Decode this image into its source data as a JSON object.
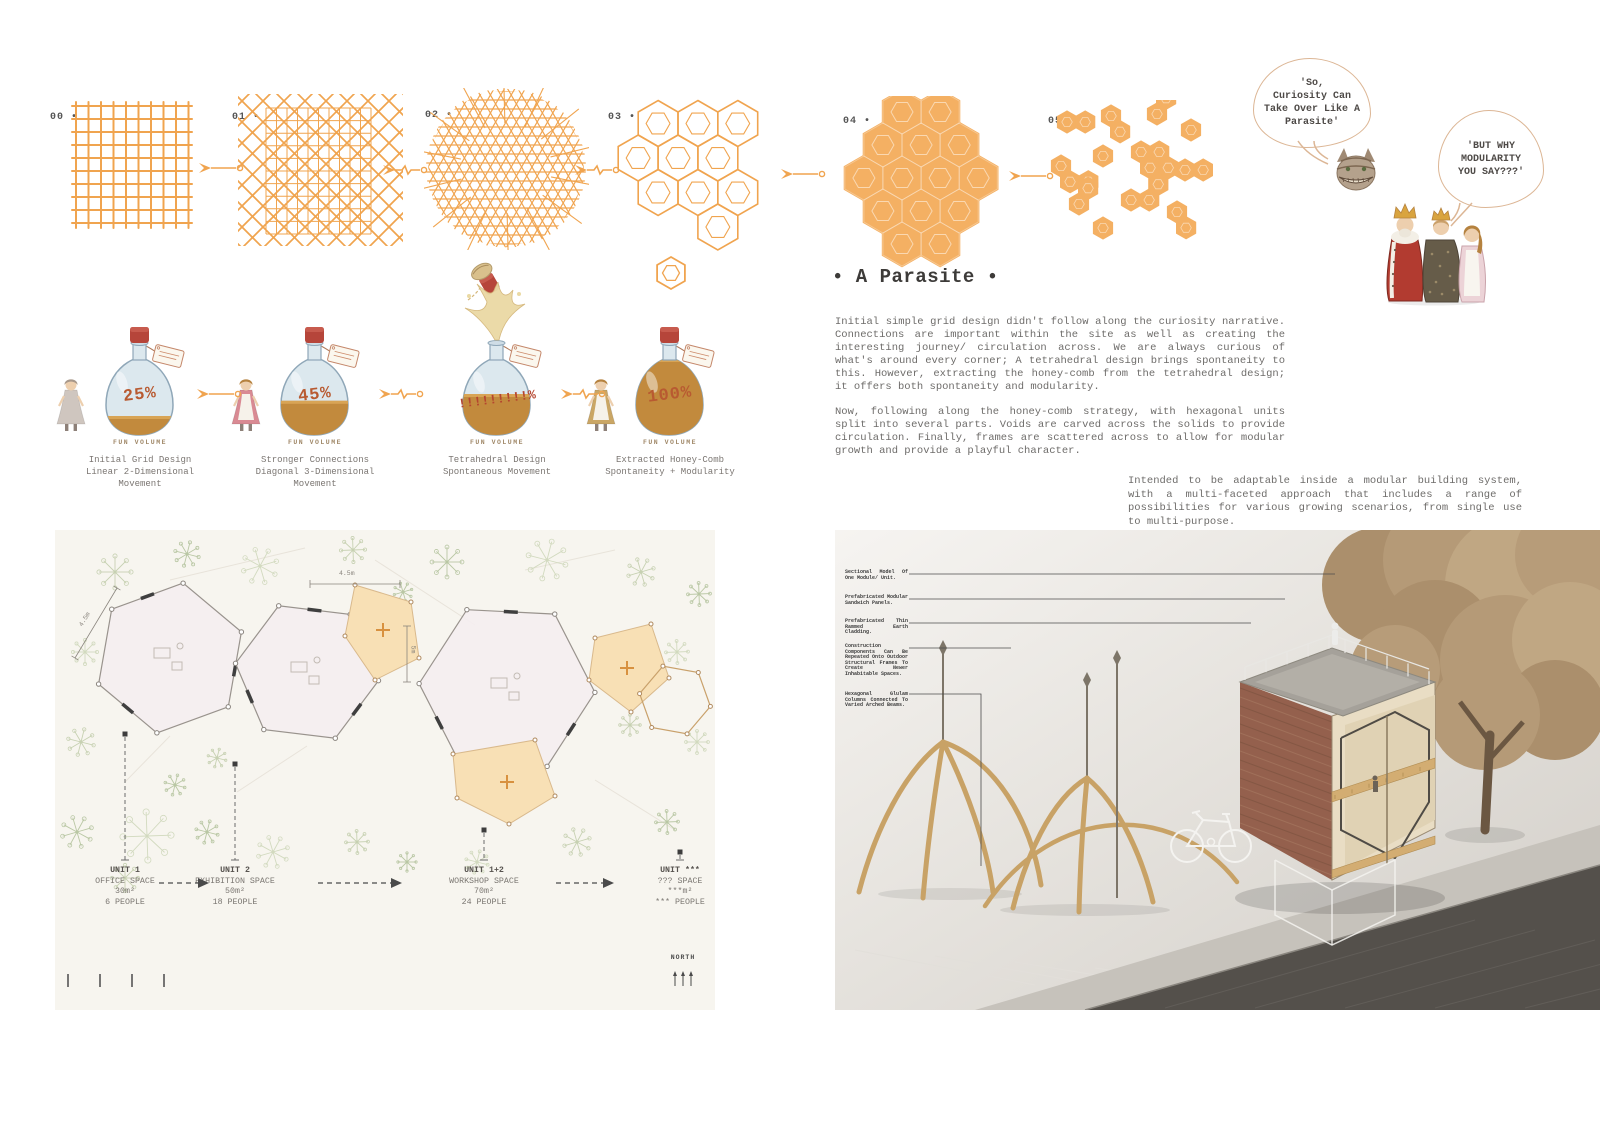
{
  "colors": {
    "accent": "#f0a44f",
    "accent_fill": "#f4b063",
    "bubble_stroke": "#dcb695",
    "ink": "#3d3b39",
    "body_text": "#6e6c6a",
    "plan_bg": "#f7f5ef",
    "annex_fill": "#f8e0b5",
    "brick": "#94604d",
    "timber": "#c8a266"
  },
  "process": {
    "steps": [
      {
        "label": "00 •",
        "type": "grid"
      },
      {
        "label": "01 •",
        "type": "diagonal-grid"
      },
      {
        "label": "02 •",
        "type": "tetrahedral-mesh"
      },
      {
        "label": "03 •",
        "type": "honeycomb-outline"
      },
      {
        "label": "04 •",
        "type": "honeycomb-solid"
      },
      {
        "label": "05 •",
        "type": "honeycomb-scattered"
      }
    ]
  },
  "bubbles": {
    "cat": "'So,\nCuriosity Can\nTake Over Like A\nParasite'",
    "royals": "'BUT WHY\nMODULARITY\nYOU SAY???'"
  },
  "potions": {
    "fun_label": "FUN VOLUME",
    "items": [
      {
        "value": "25%",
        "caption": "Initial Grid Design\nLinear 2-Dimensional\nMovement"
      },
      {
        "value": "45%",
        "caption": "Stronger Connections\nDiagonal 3-Dimensional\nMovement"
      },
      {
        "value": "!!!!!!!!!%",
        "caption": "Tetrahedral Design\nSpontaneous Movement"
      },
      {
        "value": "100%",
        "caption": "Extracted Honey-Comb\nSpontaneity + Modularity"
      }
    ]
  },
  "parasite": {
    "title": "• A Parasite •",
    "p1": "Initial simple grid design didn't follow along the curiosity narrative. Connections are important within the site as well as creating the interesting journey/ circulation across. We are always curious of what's around every corner; A tetrahedral design brings spontaneity to this. However, extracting the honey-comb from the tetrahedral design; it offers both spontaneity and modularity.",
    "p2": "Now, following along the honey-comb strategy, with hexagonal units split into several parts. Voids are carved across the solids to provide circulation. Finally, frames are scattered across to allow for modular growth and provide a playful character.",
    "note": "Intended to be adaptable inside a modular building system, with a multi-faceted approach that includes a range of possibilities for various growing scenarios, from single use to multi-purpose."
  },
  "siteplan": {
    "units": [
      {
        "name": "UNIT 1",
        "use": "OFFICE SPACE",
        "area": "30m²",
        "capacity": "6 PEOPLE"
      },
      {
        "name": "UNIT 2",
        "use": "EXHIBITION SPACE",
        "area": "50m²",
        "capacity": "18 PEOPLE"
      },
      {
        "name": "UNIT 1+2",
        "use": "WORKSHOP SPACE",
        "area": "70m²",
        "capacity": "24 PEOPLE"
      },
      {
        "name": "UNIT ***",
        "use": "??? SPACE",
        "area": "***m²",
        "capacity": "*** PEOPLE"
      }
    ],
    "dims": [
      "4.5m",
      "4.5m",
      "5m"
    ],
    "north": "NORTH"
  },
  "render": {
    "annotations": [
      "Sectional Model Of One Module/ Unit.",
      "Prefabricated Modular Sandwich Panels.",
      "Prefabricated Thin Rammed Earth Cladding.",
      "Construction Components Can Be Repeated Onto Outdoor Structural Frames To Create Newer Inhabitable Spaces.",
      "Hexagonal Glulam Columns Connected To Varied Arched Beams."
    ]
  }
}
